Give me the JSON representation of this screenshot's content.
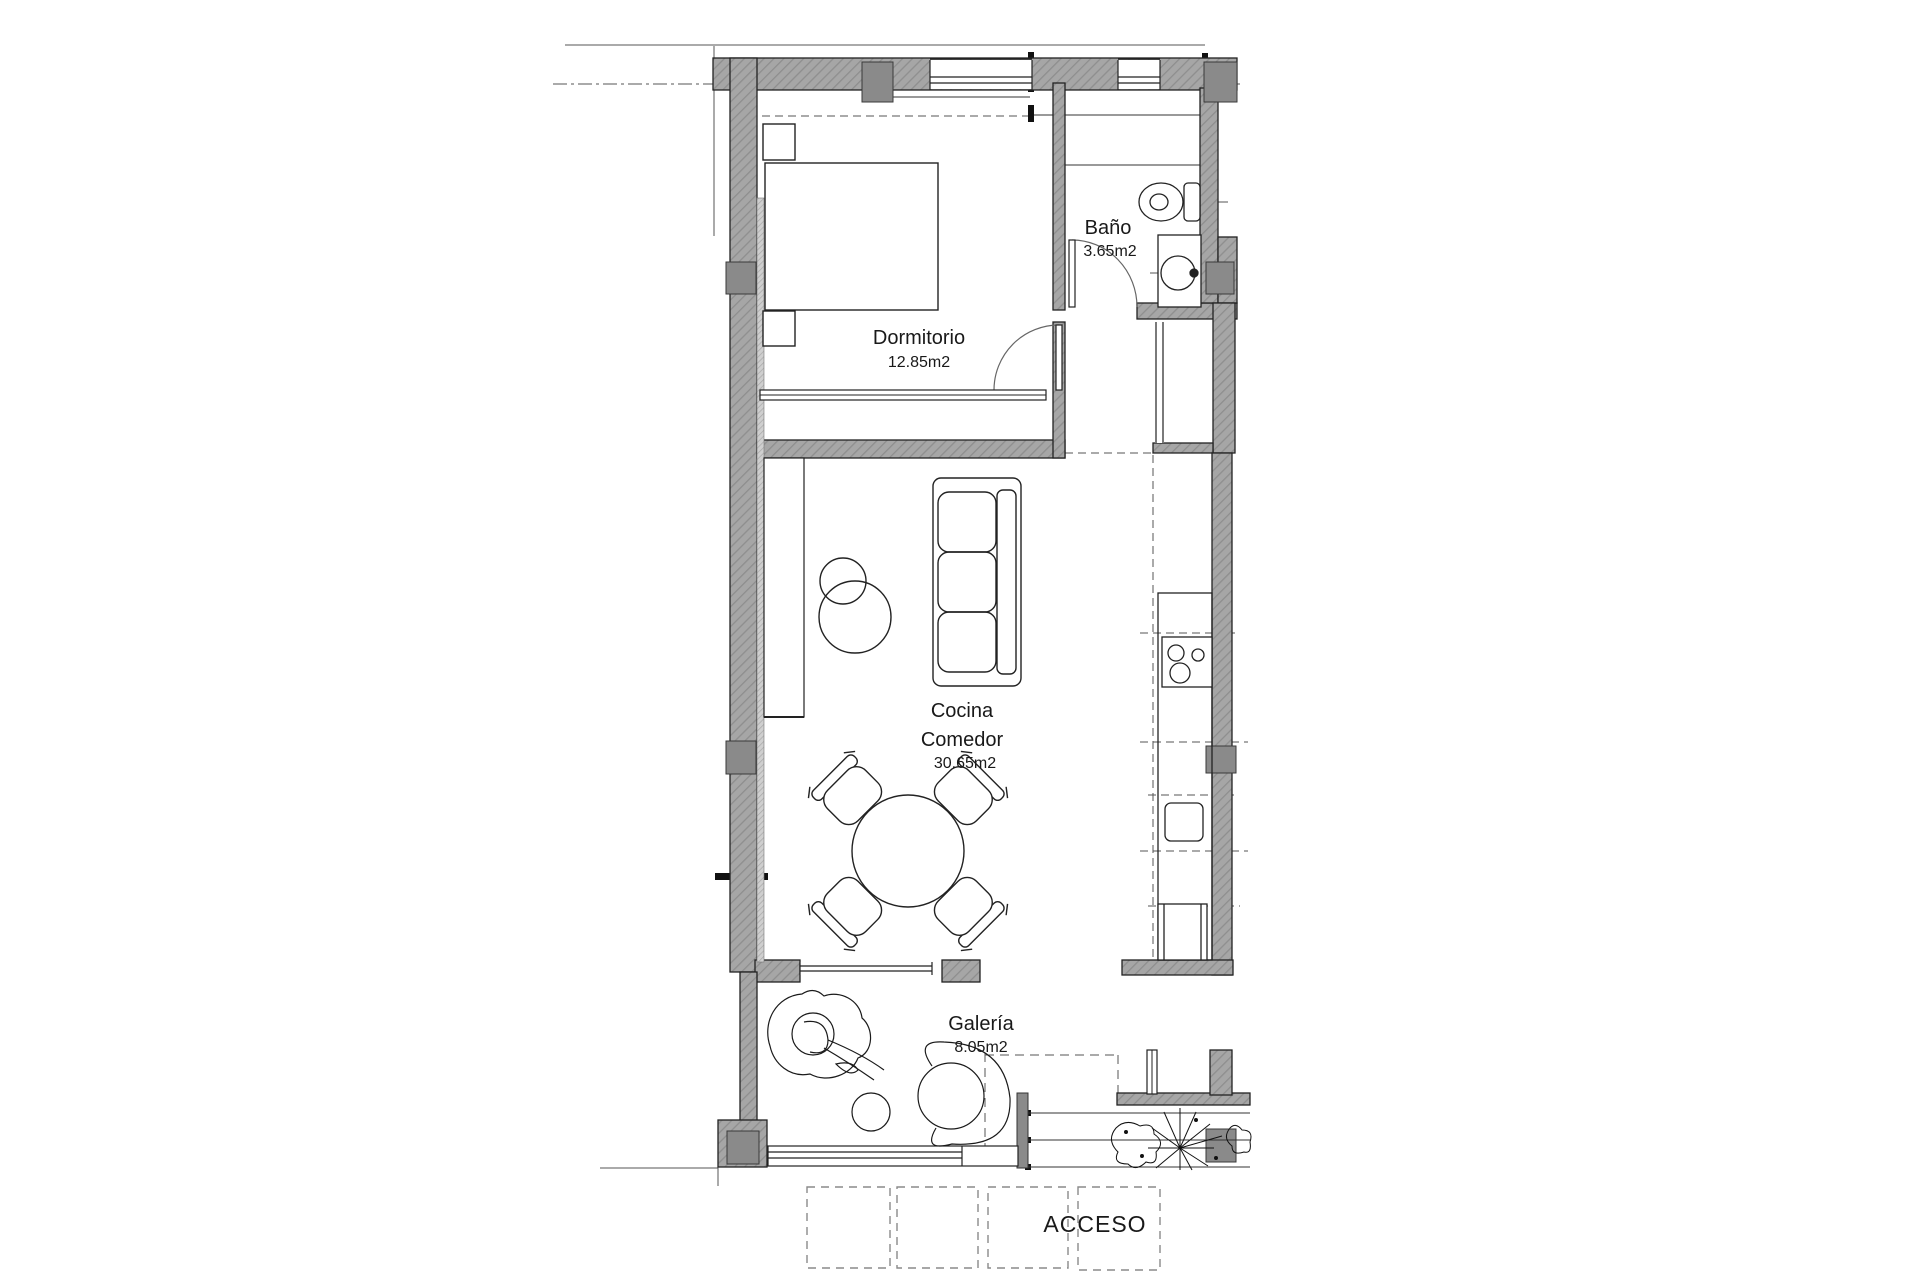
{
  "plan": {
    "type": "apartment-floor-plan",
    "rooms": {
      "dormitorio": {
        "name": "Dormitorio",
        "area": "12.85m2"
      },
      "bano": {
        "name": "Baño",
        "area": "3.65m2"
      },
      "cocina": {
        "line1": "Cocina",
        "line2": "Comedor",
        "area": "30.65m2"
      },
      "galeria": {
        "name": "Galería",
        "area": "8.05m2"
      }
    },
    "access_label": "ACCESO",
    "colors": {
      "wall_hatch_fill": "#a6a6a6",
      "wall_hatch_line": "#8e8e8e",
      "column_fill": "#8a8a8a",
      "line": "#1a1a1a",
      "reference_line": "#555555",
      "dashed_line": "#777777"
    }
  }
}
